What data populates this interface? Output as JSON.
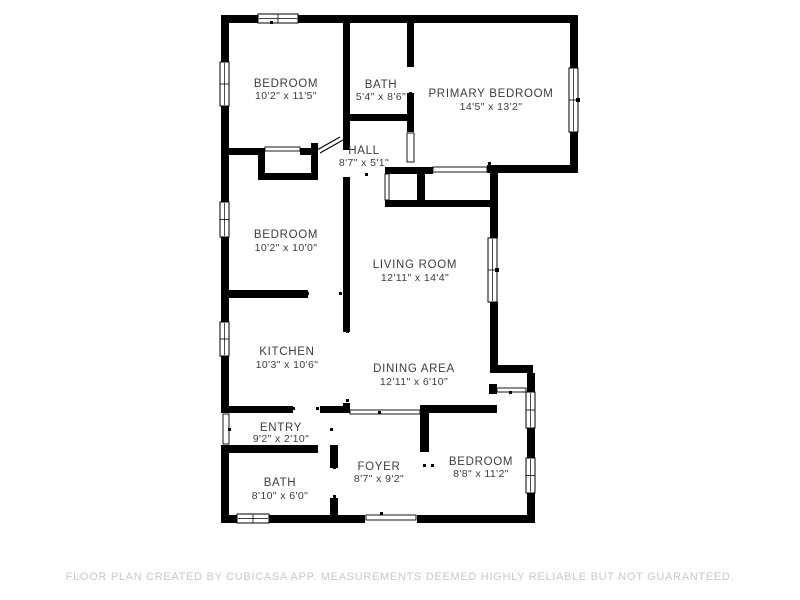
{
  "meta": {
    "canvas": {
      "w": 800,
      "h": 600
    },
    "colors": {
      "background": "#ffffff",
      "wall": "#000000",
      "label": "#3c3c3c",
      "footer": "#c8c8c8",
      "window_fill": "#ffffff"
    }
  },
  "footer": {
    "text": "FLOOR PLAN CREATED BY CUBICASA APP. MEASUREMENTS DEEMED HIGHLY RELIABLE BUT NOT GUARANTEED."
  },
  "rooms": [
    {
      "id": "bedroom-top-left",
      "name": "BEDROOM",
      "dims": "10'2\" x 11'5\"",
      "x": 286,
      "y": 87,
      "y2": 99
    },
    {
      "id": "bath-top",
      "name": "BATH",
      "dims": "5'4\" x 8'6\"",
      "x": 381,
      "y": 88,
      "y2": 100
    },
    {
      "id": "primary-bedroom",
      "name": "PRIMARY BEDROOM",
      "dims": "14'5\" x 13'2\"",
      "x": 491,
      "y": 97,
      "y2": 110
    },
    {
      "id": "hall",
      "name": "HALL",
      "dims": "8'7\" x 5'1\"",
      "x": 364,
      "y": 154,
      "y2": 166
    },
    {
      "id": "bedroom-mid-left",
      "name": "BEDROOM",
      "dims": "10'2\" x 10'0\"",
      "x": 286,
      "y": 238,
      "y2": 251
    },
    {
      "id": "living-room",
      "name": "LIVING ROOM",
      "dims": "12'11\" x 14'4\"",
      "x": 415,
      "y": 268,
      "y2": 281
    },
    {
      "id": "kitchen",
      "name": "KITCHEN",
      "dims": "10'3\" x 10'6\"",
      "x": 287,
      "y": 355,
      "y2": 368
    },
    {
      "id": "dining-area",
      "name": "DINING AREA",
      "dims": "12'11\" x 6'10\"",
      "x": 414,
      "y": 372,
      "y2": 385
    },
    {
      "id": "entry",
      "name": "ENTRY",
      "dims": "9'2\" x 2'10\"",
      "x": 281,
      "y": 431,
      "y2": 442
    },
    {
      "id": "foyer",
      "name": "FOYER",
      "dims": "8'7\" x 9'2\"",
      "x": 379,
      "y": 470,
      "y2": 482
    },
    {
      "id": "bedroom-bottom-right",
      "name": "BEDROOM",
      "dims": "8'8\" x 11'2\"",
      "x": 481,
      "y": 465,
      "y2": 477
    },
    {
      "id": "bath-bottom",
      "name": "BATH",
      "dims": "8'10\" x 6'0\"",
      "x": 280,
      "y": 486,
      "y2": 499
    }
  ],
  "walls": [
    [
      221,
      15,
      357,
      8
    ],
    [
      221,
      15,
      8,
      47
    ],
    [
      221,
      106,
      8,
      96
    ],
    [
      221,
      237,
      8,
      85
    ],
    [
      221,
      356,
      8,
      57
    ],
    [
      221,
      445,
      8,
      78
    ],
    [
      221,
      515,
      16,
      8
    ],
    [
      269,
      515,
      96,
      8
    ],
    [
      417,
      515,
      118,
      8
    ],
    [
      527,
      493,
      8,
      30
    ],
    [
      527,
      428,
      8,
      30
    ],
    [
      527,
      373,
      8,
      19
    ],
    [
      490,
      365,
      43,
      8
    ],
    [
      490,
      302,
      8,
      63
    ],
    [
      490,
      173,
      8,
      65
    ],
    [
      487,
      165,
      91,
      8
    ],
    [
      570,
      132,
      8,
      41
    ],
    [
      570,
      15,
      8,
      53
    ],
    [
      343,
      15,
      7,
      135
    ],
    [
      343,
      177,
      7,
      155
    ],
    [
      343,
      403,
      7,
      10
    ],
    [
      407,
      15,
      7,
      52
    ],
    [
      407,
      93,
      7,
      39
    ],
    [
      343,
      114,
      71,
      7
    ],
    [
      221,
      148,
      44,
      7
    ],
    [
      258,
      148,
      7,
      32
    ],
    [
      258,
      173,
      60,
      7
    ],
    [
      311,
      143,
      7,
      37
    ],
    [
      300,
      148,
      18,
      7
    ],
    [
      385,
      167,
      48,
      7
    ],
    [
      417,
      174,
      8,
      26
    ],
    [
      385,
      200,
      112,
      7
    ],
    [
      221,
      290,
      87,
      8
    ],
    [
      221,
      406,
      72,
      7
    ],
    [
      320,
      406,
      30,
      7
    ],
    [
      420,
      405,
      77,
      8
    ],
    [
      420,
      405,
      9,
      47
    ],
    [
      221,
      445,
      97,
      8
    ],
    [
      330,
      445,
      8,
      23
    ],
    [
      330,
      498,
      8,
      25
    ],
    [
      489,
      384,
      8,
      10
    ]
  ],
  "windows": [
    {
      "x": 258,
      "y": 14,
      "w": 40,
      "h": 9,
      "dir": "h",
      "double": false
    },
    {
      "x": 220,
      "y": 62,
      "w": 9,
      "h": 44,
      "dir": "v",
      "double": false
    },
    {
      "x": 220,
      "y": 202,
      "w": 9,
      "h": 35,
      "dir": "v",
      "double": false
    },
    {
      "x": 220,
      "y": 322,
      "w": 9,
      "h": 34,
      "dir": "v",
      "double": false
    },
    {
      "x": 237,
      "y": 514,
      "w": 32,
      "h": 9,
      "dir": "h",
      "double": false
    },
    {
      "x": 569,
      "y": 68,
      "w": 9,
      "h": 64,
      "dir": "v",
      "double": true
    },
    {
      "x": 488,
      "y": 238,
      "w": 9,
      "h": 64,
      "dir": "v",
      "double": true
    },
    {
      "x": 526,
      "y": 392,
      "w": 9,
      "h": 36,
      "dir": "v",
      "double": false
    },
    {
      "x": 526,
      "y": 458,
      "w": 9,
      "h": 35,
      "dir": "v",
      "double": false
    }
  ],
  "openings": [
    [
      265,
      147,
      35,
      4
    ],
    [
      407,
      133,
      7,
      29
    ],
    [
      433,
      167,
      54,
      5
    ],
    [
      385,
      174,
      4,
      26
    ],
    [
      350,
      410,
      70,
      4
    ],
    [
      497,
      388,
      29,
      4
    ],
    [
      366,
      515,
      50,
      5
    ],
    [
      223,
      414,
      6,
      30
    ]
  ],
  "diagonals": [
    [
      317,
      150,
      340,
      137
    ],
    [
      320,
      153,
      343,
      140
    ]
  ],
  "ticks": [
    [
      488,
      162
    ],
    [
      409,
      64
    ],
    [
      409,
      92
    ],
    [
      346,
      330
    ],
    [
      346,
      399
    ],
    [
      378,
      411
    ],
    [
      292,
      407
    ],
    [
      316,
      407
    ],
    [
      509,
      391
    ],
    [
      423,
      464
    ],
    [
      431,
      464
    ],
    [
      333,
      466
    ],
    [
      333,
      495
    ],
    [
      380,
      512
    ],
    [
      228,
      428
    ],
    [
      330,
      428
    ],
    [
      306,
      292
    ],
    [
      339,
      292
    ],
    [
      270,
      21
    ],
    [
      487,
      20
    ],
    [
      365,
      173
    ]
  ]
}
